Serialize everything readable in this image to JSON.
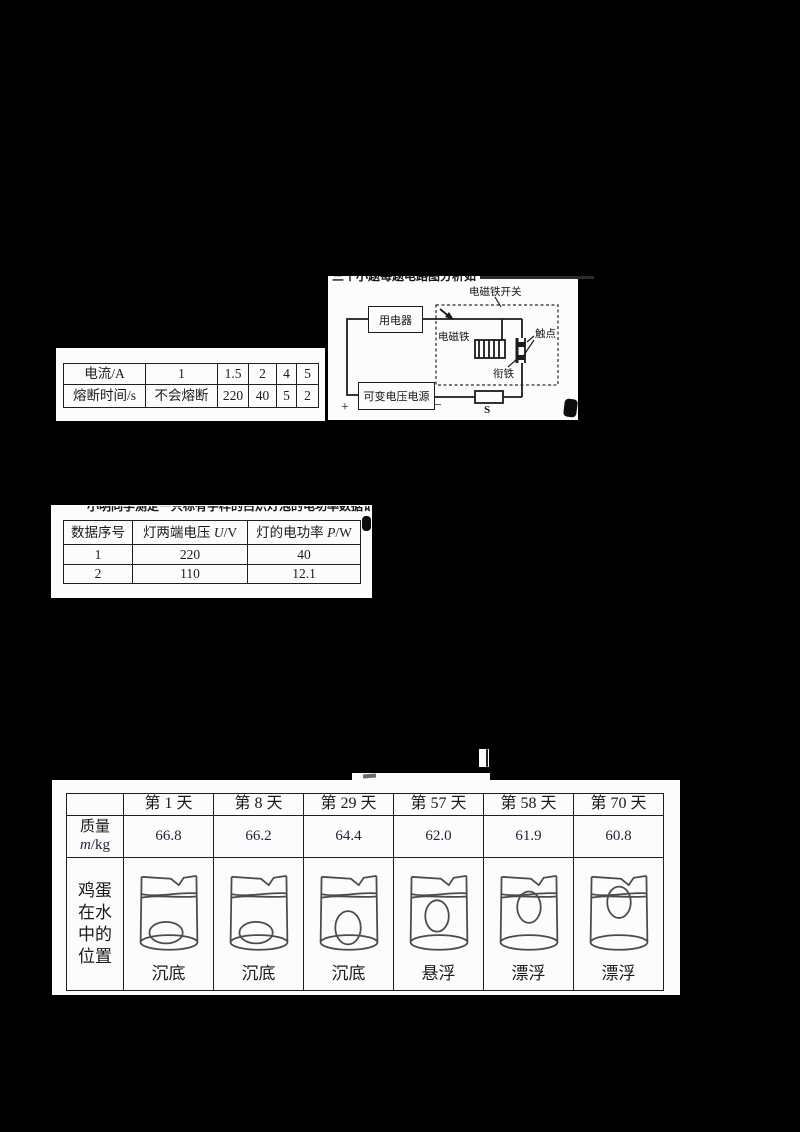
{
  "colors": {
    "background": "#000000",
    "paper": "#fcfcfc",
    "ink": "#1a1a1a",
    "drawing_gray": "#4b4b4b",
    "digit_ink": "#1c2136"
  },
  "fuse_table": {
    "rows": [
      [
        "电流/A",
        "1",
        "1.5",
        "2",
        "4",
        "5"
      ],
      [
        "熔断时间/s",
        "不会熔断",
        "220",
        "40",
        "5",
        "2"
      ]
    ]
  },
  "circuit": {
    "labels": {
      "switch_title": "电磁铁开关",
      "appliance": "用电器",
      "electromagnet": "电磁铁",
      "contact": "触点",
      "armature": "衔铁",
      "power_supply": "可变电压电源",
      "plus": "+",
      "minus": "−",
      "switch_s": "S"
    },
    "top_fragment": "三个小题每题电路图分析如下所示"
  },
  "lamp_table": {
    "headers": [
      "数据序号",
      "灯两端电压",
      "灯的电功率"
    ],
    "header_syms": [
      {
        "sym": "",
        "unit": ""
      },
      {
        "sym": "U",
        "unit": "/V"
      },
      {
        "sym": "P",
        "unit": "/W"
      }
    ],
    "rows": [
      [
        "1",
        "220",
        "40"
      ],
      [
        "2",
        "110",
        "12.1"
      ]
    ],
    "top_fragment": "小明同学测定一只标有字样的白炽灯泡的电功率数据记"
  },
  "egg_table": {
    "day_headers": [
      "第 1 天",
      "第 8 天",
      "第 29 天",
      "第 57 天",
      "第 58 天",
      "第 70 天"
    ],
    "mass_label": "质量",
    "mass_sym": "m",
    "mass_unit": "/kg",
    "mass_values": [
      "66.8",
      "66.2",
      "64.4",
      "62.0",
      "61.9",
      "60.8"
    ],
    "position_label_lines": [
      "鸡蛋",
      "在水",
      "中的",
      "位置"
    ],
    "positions": [
      "沉底",
      "沉底",
      "沉底",
      "悬浮",
      "漂浮",
      "漂浮"
    ],
    "egg_states": [
      "bottom-flat",
      "bottom-flat",
      "bottom-upright",
      "suspended",
      "floating",
      "floating-high"
    ]
  },
  "fragments": {
    "above_egg_smudge": "一",
    "bracket": "〕"
  }
}
